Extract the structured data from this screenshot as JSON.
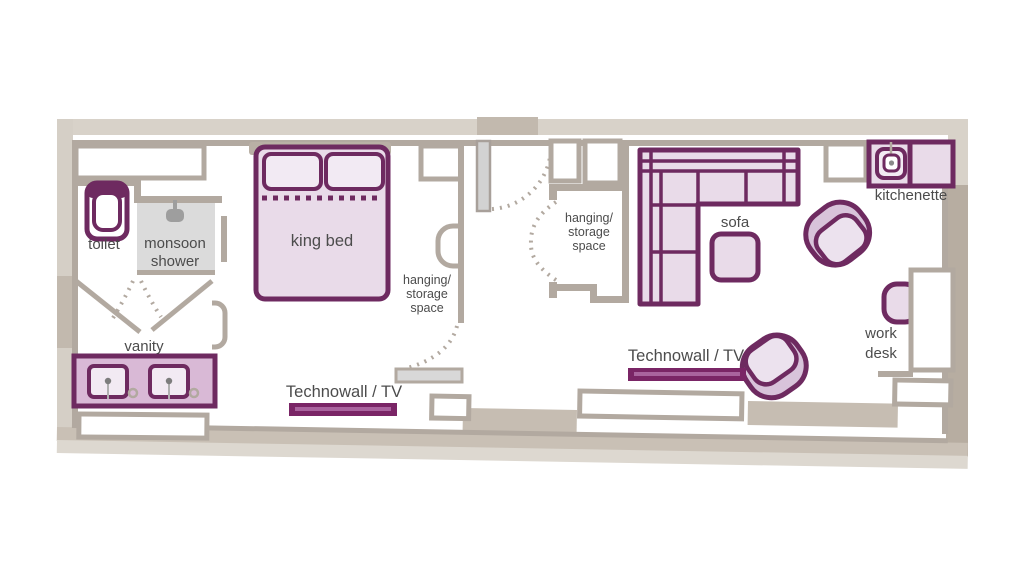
{
  "title": "studio suite floor plan",
  "labels": {
    "toilet": "toilet",
    "monsoon_shower": [
      "monsoon",
      "shower"
    ],
    "king_bed": "king bed",
    "vanity": "vanity",
    "hanging_storage": [
      "hanging/",
      "storage",
      "space"
    ],
    "technowall": "Technowall / TV",
    "sofa": "sofa",
    "kitchenette": "kitchenette",
    "work_desk": [
      "work",
      "desk"
    ]
  },
  "palette": {
    "plum_outline": "#6e2a60",
    "plum_tv_bar": "#7a2566",
    "plum_tv_inner": "#a9639e",
    "furniture_fill": "#e9dbe9",
    "furniture_fill_light": "#f2eaf3",
    "vanity_fill": "#d9b9d6",
    "chair_shell": "#d8c3da",
    "chair_seat": "#ece2ee",
    "wall_grey": "#b2a9a0",
    "outer_wall_beige": "#d8d2c9",
    "outer_wall_dark": "#b7ada1",
    "outer_band_taupe": "#c9c0b5",
    "outer_band_light": "#ddd8d0",
    "shower_fill": "#dbdbdb",
    "label_text": "#4c4c4c"
  }
}
